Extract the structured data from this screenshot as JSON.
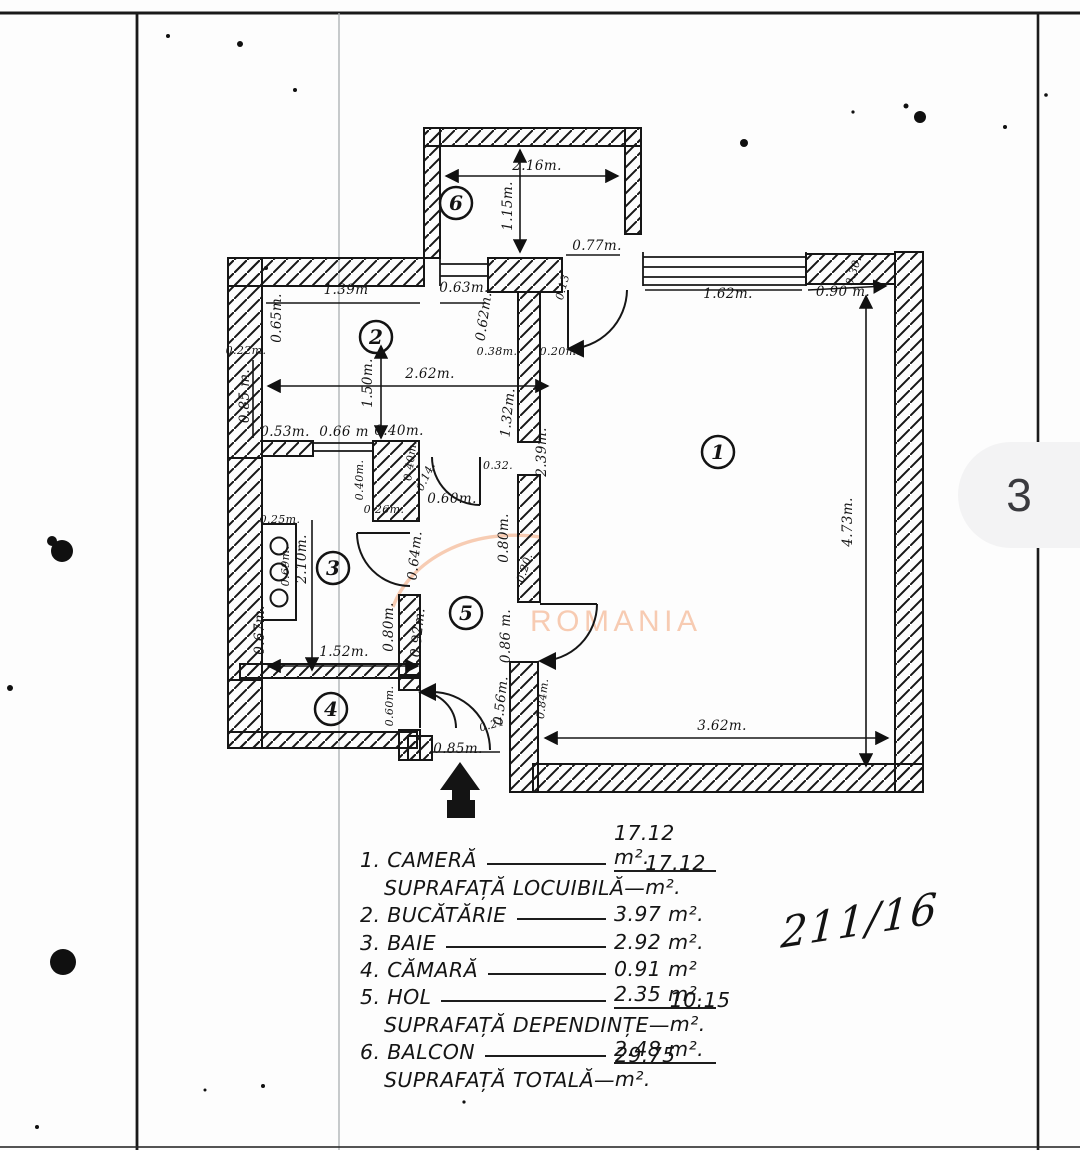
{
  "page": {
    "number": "3",
    "stamp": "211/16"
  },
  "watermark": {
    "text": "ROMANIA",
    "color": "#f6c3a6"
  },
  "plan": {
    "rooms": [
      {
        "n": "1",
        "x": 718,
        "y": 452
      },
      {
        "n": "2",
        "x": 376,
        "y": 337
      },
      {
        "n": "3",
        "x": 333,
        "y": 568
      },
      {
        "n": "4",
        "x": 331,
        "y": 709
      },
      {
        "n": "5",
        "x": 466,
        "y": 613
      },
      {
        "n": "6",
        "x": 456,
        "y": 203
      }
    ],
    "dims": [
      {
        "t": "2.16m.",
        "x": 537,
        "y": 170,
        "r": 0
      },
      {
        "t": "1.15m.",
        "x": 512,
        "y": 206,
        "r": -90
      },
      {
        "t": "0.77m.",
        "x": 597,
        "y": 250,
        "r": 0
      },
      {
        "t": "1.62m.",
        "x": 728,
        "y": 298,
        "r": 0
      },
      {
        "t": "0.90 m.",
        "x": 843,
        "y": 296,
        "r": 0
      },
      {
        "t": "0.30.",
        "x": 857,
        "y": 272,
        "r": -72,
        "s": 1
      },
      {
        "t": "0.13",
        "x": 566,
        "y": 288,
        "r": -75,
        "s": 1
      },
      {
        "t": "1.39m",
        "x": 346,
        "y": 294,
        "r": 0
      },
      {
        "t": "0.63m.",
        "x": 464,
        "y": 292,
        "r": 0
      },
      {
        "t": "0.65m.",
        "x": 281,
        "y": 318,
        "r": -90
      },
      {
        "t": "0.62m.",
        "x": 488,
        "y": 317,
        "r": -82
      },
      {
        "t": "0.22m.",
        "x": 246,
        "y": 354,
        "r": 0,
        "s": 1
      },
      {
        "t": "0.38m.",
        "x": 497,
        "y": 355,
        "r": 0,
        "s": 1
      },
      {
        "t": "0.20m.",
        "x": 560,
        "y": 355,
        "r": 0,
        "s": 1
      },
      {
        "t": "2.62m.",
        "x": 430,
        "y": 378,
        "r": 0
      },
      {
        "t": "1.50m.",
        "x": 372,
        "y": 383,
        "r": -90
      },
      {
        "t": "0.85 m.",
        "x": 249,
        "y": 396,
        "r": -90
      },
      {
        "t": "0.53m.",
        "x": 285,
        "y": 436,
        "r": 0
      },
      {
        "t": "0.66 m",
        "x": 344,
        "y": 436,
        "r": 0
      },
      {
        "t": "0.40m.",
        "x": 399,
        "y": 435,
        "r": 0
      },
      {
        "t": "0.40m.",
        "x": 363,
        "y": 480,
        "r": -90,
        "s": 1
      },
      {
        "t": "0.40m.",
        "x": 414,
        "y": 461,
        "r": -82,
        "s": 1
      },
      {
        "t": "0.14.",
        "x": 429,
        "y": 478,
        "r": -65,
        "s": 1
      },
      {
        "t": "0.32.",
        "x": 498,
        "y": 469,
        "r": 0,
        "s": 1
      },
      {
        "t": "1.32m.",
        "x": 512,
        "y": 413,
        "r": -84
      },
      {
        "t": "2.39m.",
        "x": 546,
        "y": 452,
        "r": -90
      },
      {
        "t": "0.26m.",
        "x": 384,
        "y": 513,
        "r": 0,
        "s": 1
      },
      {
        "t": "0.60m.",
        "x": 452,
        "y": 503,
        "r": 0
      },
      {
        "t": "0.80m.",
        "x": 508,
        "y": 538,
        "r": -90
      },
      {
        "t": "0.20.",
        "x": 528,
        "y": 569,
        "r": -72,
        "s": 1
      },
      {
        "t": "0.25m.",
        "x": 280,
        "y": 523,
        "r": 0,
        "s": 1
      },
      {
        "t": "0.69m.",
        "x": 289,
        "y": 566,
        "r": -90,
        "s": 1
      },
      {
        "t": "2.10m.",
        "x": 306,
        "y": 559,
        "r": -90
      },
      {
        "t": "0.64m.",
        "x": 419,
        "y": 556,
        "r": -84
      },
      {
        "t": "0.80m.",
        "x": 393,
        "y": 627,
        "r": -90
      },
      {
        "t": "0.92m.",
        "x": 422,
        "y": 633,
        "r": -84
      },
      {
        "t": "0.67m.",
        "x": 264,
        "y": 630,
        "r": -90
      },
      {
        "t": "1.52m.",
        "x": 344,
        "y": 656,
        "r": 0
      },
      {
        "t": "0.86 m.",
        "x": 510,
        "y": 636,
        "r": -90
      },
      {
        "t": "0.56m.",
        "x": 505,
        "y": 701,
        "r": -84
      },
      {
        "t": "0.84m.",
        "x": 546,
        "y": 699,
        "r": -84,
        "s": 1
      },
      {
        "t": "0.21",
        "x": 493,
        "y": 728,
        "r": -15,
        "s": 1
      },
      {
        "t": "0.85m.",
        "x": 458,
        "y": 753,
        "r": 0
      },
      {
        "t": "0.60m.",
        "x": 393,
        "y": 706,
        "r": -90,
        "s": 1
      },
      {
        "t": "4.73m.",
        "x": 852,
        "y": 522,
        "r": -90
      },
      {
        "t": "3.62m.",
        "x": 722,
        "y": 730,
        "r": 0
      }
    ]
  },
  "legend": {
    "rows": [
      {
        "type": "item-sub",
        "label": "1. CAMERĂ",
        "value": "17.12 m²."
      },
      {
        "type": "summary",
        "label": "SUPRAFAȚĂ LOCUIBILĂ—",
        "value": "17.12 m²."
      },
      {
        "type": "item",
        "label": "2. BUCĂTĂRIE",
        "value": "3.97 m²."
      },
      {
        "type": "item",
        "label": "3. BAIE",
        "value": "2.92 m²."
      },
      {
        "type": "item",
        "label": "4. CĂMARĂ",
        "value": "0.91 m²"
      },
      {
        "type": "item-sub",
        "label": "5. HOL",
        "value": "2.35 m²."
      },
      {
        "type": "summary",
        "label": "SUPRAFAȚĂ DEPENDINȚE—",
        "value": "10.15 m²."
      },
      {
        "type": "item-sub",
        "label": "6. BALCON",
        "value": "2.48 m²."
      },
      {
        "type": "summary",
        "label": "SUPRAFAȚĂ TOTALĂ—",
        "value": "29.75 m²."
      }
    ]
  }
}
